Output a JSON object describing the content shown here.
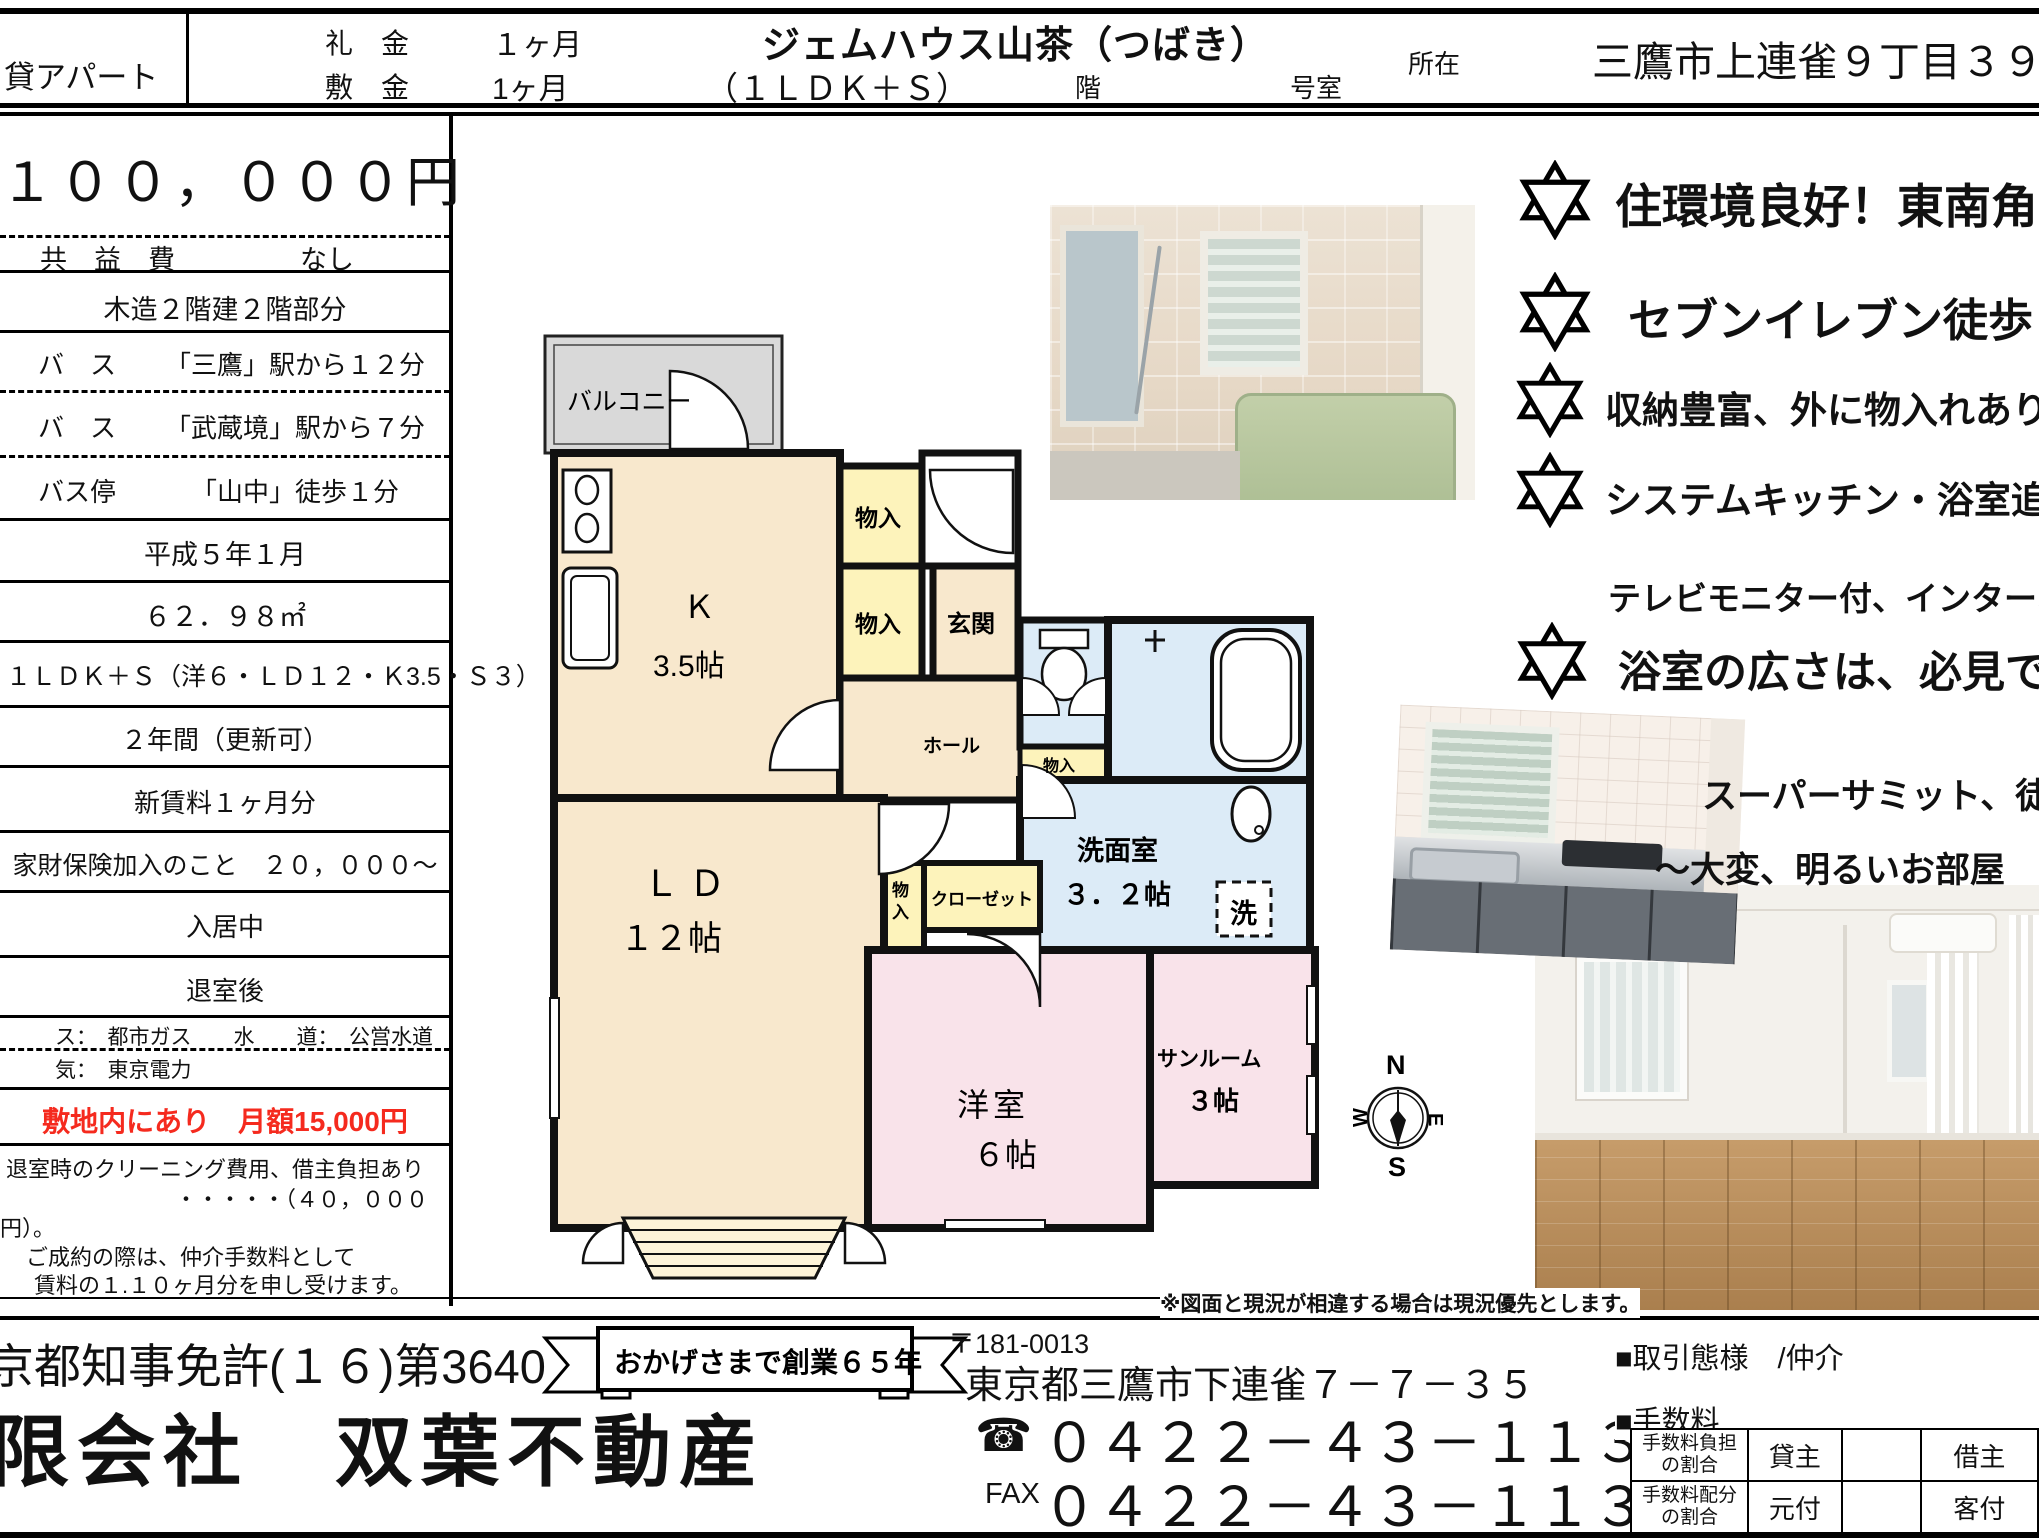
{
  "header": {
    "property_type": "貸アパート",
    "reikin_label": "礼　金",
    "reikin_value": "１ヶ月",
    "shikikin_label": "敷　金",
    "shikikin_value": "1ヶ月",
    "building_name": "ジェムハウス山茶（つばき）",
    "layout": "（１ＬＤＫ＋Ｓ）",
    "floor_label": "階",
    "room_label": "号室",
    "location_label": "所在",
    "address": "三鷹市上連雀９丁目３９番１１"
  },
  "left_table": {
    "rent": "１００，０００円",
    "kyoekihi_label": "共　益　費",
    "kyoekihi_value": "なし",
    "structure": "木造２階建２階部分",
    "access": [
      {
        "label": "バ　ス",
        "value": "「三鷹」駅から１２分"
      },
      {
        "label": "バ　ス",
        "value": "「武蔵境」駅から７分"
      },
      {
        "label": "バス停",
        "value": "「山中」徒歩１分"
      }
    ],
    "built": "平成５年１月",
    "area": "６２．９８㎡",
    "layout_detail": "１ＬＤＫ＋Ｓ（洋６・ＬＤ１２・Ｋ3.5・Ｓ３）",
    "contract": "２年間（更新可）",
    "renewal_fee": "新賃料１ヶ月分",
    "insurance": "家財保険加入のこと　２０，０００〜",
    "status": "入居中",
    "move_in": "退室後",
    "utilities_line1": "ス：　都市ガス　　水　　道：　公営水道",
    "utilities_line2": "気：　東京電力",
    "parking": "敷地内にあり　月額15,000円",
    "parking_color": "#f52a1e",
    "notes": [
      "退室時のクリーニング費用、借主負担あり",
      "・・・・・（４０，０００",
      "円）。",
      "ご成約の際は、仲介手数料として",
      "賃料の１.１０ヶ月分を申し受けます。"
    ]
  },
  "floorplan": {
    "balcony": "バルコニー",
    "kitchen": "Ｋ",
    "kitchen_size": "3.5帖",
    "monoire": "物入",
    "monoire_char1": "物",
    "monoire_char2": "入",
    "genkan": "玄関",
    "hall": "ホール",
    "ld": "ＬＤ",
    "ld_size": "１２帖",
    "closet": "クローゼット",
    "senmen": "洗面室",
    "senmen_size": "３．２帖",
    "laundry": "洗",
    "yoshitsu": "洋室",
    "yoshitsu_size": "６帖",
    "sunroom": "サンルーム",
    "sunroom_size": "３帖",
    "compass": {
      "n": "N",
      "s": "S",
      "e": "E",
      "w": "W"
    }
  },
  "highlights": [
    {
      "text": "住環境良好！東南角部屋"
    },
    {
      "text": "セブンイレブン徒歩１分"
    },
    {
      "text": "収納豊富、外に物入れあり（玄関"
    },
    {
      "text": "システムキッチン・浴室追焚機能"
    },
    {
      "text": "テレビモニター付、インターホーン"
    },
    {
      "text": "浴室の広さは、必見です"
    },
    {
      "text": "スーパーサミット、徒歩"
    },
    {
      "text": "〜大変、明るいお部屋"
    }
  ],
  "footer": {
    "disclaimer": "※図面と現況が相違する場合は現況優先とします。",
    "license": "東京都知事免許(１６)第3640",
    "company": "有限会社　双葉不動産",
    "ribbon": "おかげさまで創業６５年",
    "postal": "〒181-0013",
    "company_address": "東京都三鷹市下連雀７－７－３５",
    "tel_icon": "☎",
    "tel": "０４２２－４３－１１３１",
    "fax_label": "FAX",
    "fax": "０４２２－４３－１１３３",
    "deal_type": "■取引態様　/仲介",
    "fee_label": "■手数料",
    "fee_table": [
      {
        "label1": "手数料負担",
        "label2": "の割合",
        "c1": "貸主",
        "c2": "",
        "c3": "借主"
      },
      {
        "label1": "手数料配分",
        "label2": "の割合",
        "c1": "元付",
        "c2": "",
        "c3": "客付"
      }
    ]
  }
}
